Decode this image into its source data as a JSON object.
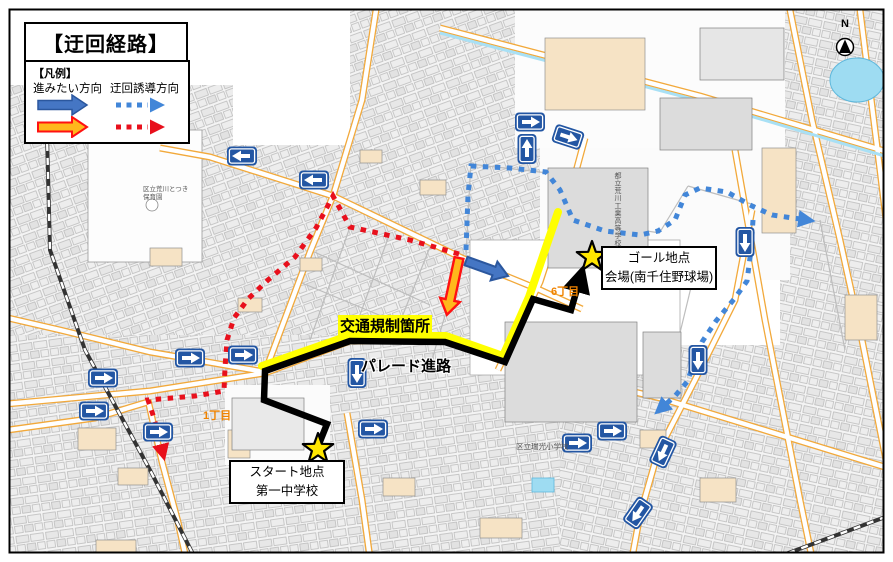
{
  "labels": {
    "title": "【迂回経路】",
    "legend_heading": "【凡例】",
    "legend_col1": "進みたい方向",
    "legend_col2": "迂回誘導方向",
    "traffic_control": "交通規制箇所",
    "parade_route": "パレード進路",
    "goal_line1": "ゴール地点",
    "goal_line2": "会場(南千住野球場)",
    "start_line1": "スタート地点",
    "start_line2": "第一中学校",
    "district_1": "1丁目",
    "district_6": "6丁目",
    "school_elem": "区立瑞光小学校",
    "school_tech": "都立荒川工業高等学校",
    "nursery": "区立荒川とつき保育園",
    "north": "N"
  },
  "colors": {
    "red_detour": "#e8101c",
    "blue_detour": "#4286d8",
    "blue_arrow_fill": "#4576c4",
    "blue_arrow_border": "#2b579e",
    "orange_arrow_fill": "#ffb81c",
    "orange_arrow_border": "#ff1111",
    "parade_black": "#000000",
    "regulation_yellow": "#ffff00",
    "sign_blue": "#2356a3",
    "star_fill": "#ffe600",
    "district_orange": "#f08300",
    "road_casing": "#f2a93b",
    "water": "#9edcf2"
  },
  "map": {
    "routes": [
      {
        "name": "regulation-yellow-route",
        "style": "yellow",
        "points": [
          [
            262,
            366
          ],
          [
            348,
            336
          ],
          [
            446,
            336
          ],
          [
            503,
            356
          ],
          [
            529,
            297
          ],
          [
            558,
            212
          ]
        ]
      },
      {
        "name": "parade-route-line",
        "style": "black",
        "points": [
          [
            319,
            444
          ],
          [
            327,
            424
          ],
          [
            264,
            400
          ],
          [
            265,
            371
          ],
          [
            350,
            341
          ],
          [
            445,
            342
          ],
          [
            505,
            362
          ],
          [
            533,
            299
          ],
          [
            571,
            310
          ],
          [
            577,
            289
          ]
        ]
      },
      {
        "name": "red-detour-route",
        "style": "red-dot",
        "points": [
          [
            459,
            254
          ],
          [
            410,
            240
          ],
          [
            350,
            227
          ],
          [
            333,
            196
          ],
          [
            316,
            228
          ],
          [
            295,
            257
          ],
          [
            268,
            280
          ],
          [
            248,
            299
          ],
          [
            234,
            318
          ],
          [
            227,
            340
          ],
          [
            225,
            368
          ],
          [
            224,
            391
          ],
          [
            195,
            396
          ],
          [
            148,
            400
          ],
          [
            154,
            418
          ],
          [
            161,
            446
          ]
        ]
      },
      {
        "name": "blue-detour-route-main",
        "style": "blue-dot",
        "points": [
          [
            466,
            250
          ],
          [
            468,
            195
          ],
          [
            471,
            166
          ],
          [
            510,
            168
          ],
          [
            546,
            172
          ],
          [
            560,
            190
          ],
          [
            573,
            220
          ],
          [
            605,
            231
          ],
          [
            640,
            235
          ],
          [
            658,
            231
          ],
          [
            675,
            220
          ],
          [
            685,
            195
          ],
          [
            700,
            188
          ],
          [
            727,
            192
          ],
          [
            752,
            206
          ],
          [
            772,
            215
          ],
          [
            800,
            219
          ]
        ]
      },
      {
        "name": "blue-detour-route-branch",
        "style": "blue-dot",
        "points": [
          [
            753,
            220
          ],
          [
            751,
            250
          ],
          [
            747,
            281
          ],
          [
            735,
            298
          ],
          [
            716,
            321
          ],
          [
            702,
            342
          ],
          [
            694,
            363
          ],
          [
            687,
            382
          ],
          [
            675,
            396
          ],
          [
            666,
            404
          ]
        ]
      }
    ],
    "solid_arrows": [
      {
        "name": "desired-direction-east-arrow",
        "style": "blue-solid",
        "from": [
          466,
          261
        ],
        "to": [
          494,
          271
        ]
      },
      {
        "name": "desired-direction-south-arrow",
        "style": "orange-solid",
        "from": [
          459,
          258
        ],
        "to": [
          450,
          300
        ]
      }
    ],
    "stars": [
      {
        "name": "goal-star",
        "x": 592,
        "y": 257
      },
      {
        "name": "start-star",
        "x": 318,
        "y": 449
      }
    ],
    "one_way_signs": [
      {
        "x": 242,
        "y": 156,
        "r": 180
      },
      {
        "x": 314,
        "y": 180,
        "r": 180
      },
      {
        "x": 530,
        "y": 122,
        "r": 0
      },
      {
        "x": 568,
        "y": 137,
        "r": 18
      },
      {
        "x": 527,
        "y": 149,
        "r": -90
      },
      {
        "x": 745,
        "y": 242,
        "r": 90
      },
      {
        "x": 698,
        "y": 360,
        "r": 90
      },
      {
        "x": 103,
        "y": 378,
        "r": 0
      },
      {
        "x": 94,
        "y": 411,
        "r": 0
      },
      {
        "x": 190,
        "y": 358,
        "r": 0
      },
      {
        "x": 243,
        "y": 355,
        "r": 0
      },
      {
        "x": 158,
        "y": 432,
        "r": 0
      },
      {
        "x": 373,
        "y": 429,
        "r": 0
      },
      {
        "x": 357,
        "y": 373,
        "r": 90
      },
      {
        "x": 577,
        "y": 443,
        "r": 0
      },
      {
        "x": 612,
        "y": 431,
        "r": 0
      },
      {
        "x": 663,
        "y": 452,
        "r": 115
      },
      {
        "x": 638,
        "y": 513,
        "r": 125
      }
    ]
  }
}
